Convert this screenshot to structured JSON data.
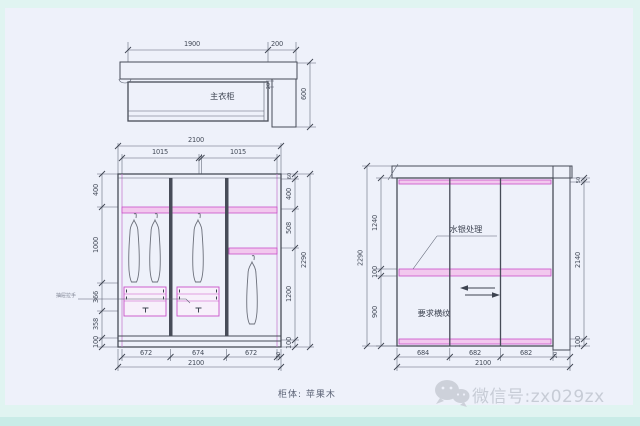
{
  "top_view": {
    "label": "主衣柜",
    "dim_width_main": "1900",
    "dim_width_return": "200",
    "dim_depth": "600",
    "dim_offset": "20"
  },
  "front_elevation": {
    "dim_total_top": "2100",
    "dim_half_left": "1015",
    "dim_half_right": "1015",
    "dims_left": [
      "400",
      "1000",
      "366",
      "358",
      "100"
    ],
    "dims_right": [
      "60",
      "400",
      "508",
      "1200",
      "100"
    ],
    "dim_overall_right": "2290",
    "dims_bottom": [
      "672",
      "674",
      "672"
    ],
    "dim_bottom_end": "20",
    "dim_total_bottom": "2100",
    "drawer_note": "抽屉拉手"
  },
  "door_elevation": {
    "panel_note": "水银处理",
    "grain_note": "要求横纹",
    "dims_left": [
      "1240",
      "100",
      "900"
    ],
    "dim_overall_left": "2290",
    "dims_right": [
      "50",
      "2140",
      "100"
    ],
    "dims_bottom": [
      "684",
      "682",
      "682"
    ],
    "dim_bottom_end": "20",
    "dim_total_bottom": "2100"
  },
  "footer": {
    "material_note": "柜体: 苹果木"
  },
  "watermark": {
    "wechat_label": "微信号:zx029zx",
    "wechat_icon": "wechat-bubbles-icon"
  },
  "colors": {
    "accent_magenta": "#c94fc9",
    "line_dark": "#474c58",
    "canvas": "#eef1fa",
    "margin_cyan": "#e0f4f1",
    "watermark_gray": "#c7ccd6"
  }
}
